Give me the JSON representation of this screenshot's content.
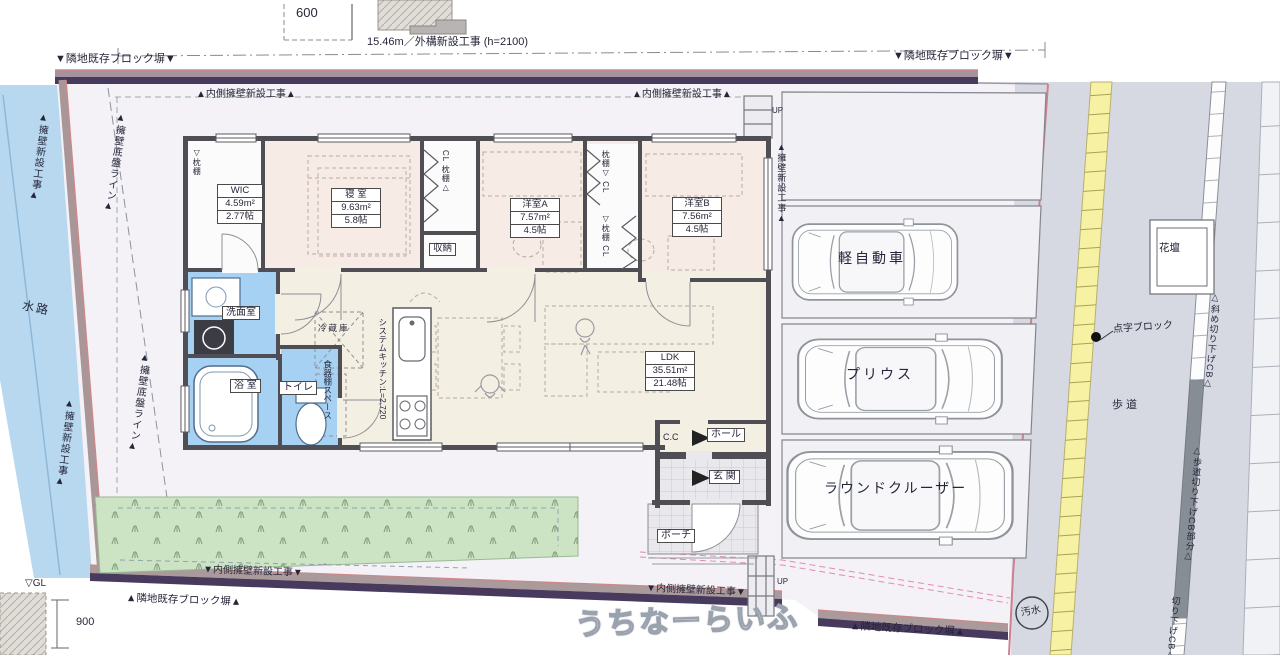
{
  "dims": {
    "d600": "600",
    "d900": "900",
    "frontage": "15.46m／外構新設工事 (h=2100)",
    "gl": "▽GL"
  },
  "boundaries": {
    "top_left": "▼隣地既存ブロック塀▼",
    "top_right": "▼隣地既存ブロック塀▼",
    "bottom_left": "▲隣地既存ブロック塀▲",
    "bottom_right": "▲隣地既存ブロック塀▲",
    "inner_top_left": "▲内側擁壁新設工事▲",
    "inner_top_right": "▲内側擁壁新設工事▲",
    "inner_bottom_left": "▼内側擁壁新設工事▼",
    "inner_bottom_right": "▼内側擁壁新設工事▼",
    "retaining_upper": "▲擁壁新設工事▲",
    "retaining_lower": "▲擁壁新設工事▲",
    "retaining_parking": "▲擁壁新設工事▲",
    "base_line_upper": "▲擁壁底盤ライン▲",
    "base_line_lower": "▲擁壁底盤ライン▲"
  },
  "site": {
    "waterway": "水路",
    "sidewalk": "歩道",
    "flower_bed": "花壇",
    "tactile": "点字ブロック",
    "sewer": "汚水",
    "curb_slope": "△斜め切り下げCB△",
    "curb_cut": "△歩道切り下げCB部分△",
    "curb_cut2": "切り下げCB△",
    "up_top": "UP",
    "up_bottom": "UP"
  },
  "rooms": {
    "wic": {
      "name": "WIC",
      "area": "4.59m²",
      "size": "2.77帖"
    },
    "bedroom": {
      "name": "寝 室",
      "area": "9.63m²",
      "size": "5.8帖"
    },
    "western_a": {
      "name": "洋室A",
      "area": "7.57m²",
      "size": "4.5帖"
    },
    "western_b": {
      "name": "洋室B",
      "area": "7.56m²",
      "size": "4.5帖"
    },
    "ldk": {
      "name": "LDK",
      "area": "35.51m²",
      "size": "21.48帖"
    },
    "washroom": "洗面室",
    "bath": "浴 室",
    "toilet": "トイレ",
    "storage": "収納",
    "fridge": "冷蔵庫",
    "cupboard": "食器棚スペース",
    "kitchen": "システムキッチン:L=2,720",
    "cc": "C.C",
    "hall": "ホール",
    "entrance": "玄 関",
    "porch": "ポーチ",
    "shelf_wic": "▽枕棚",
    "closet1": "CL 枕棚△",
    "closet2": "枕棚▽ CL",
    "closet3": "▽枕棚 CL"
  },
  "parking": {
    "kei": "軽自動車",
    "prius": "プリウス",
    "cruiser": "ラウンドクルーザー"
  },
  "watermark": "うちなーらいふ"
}
